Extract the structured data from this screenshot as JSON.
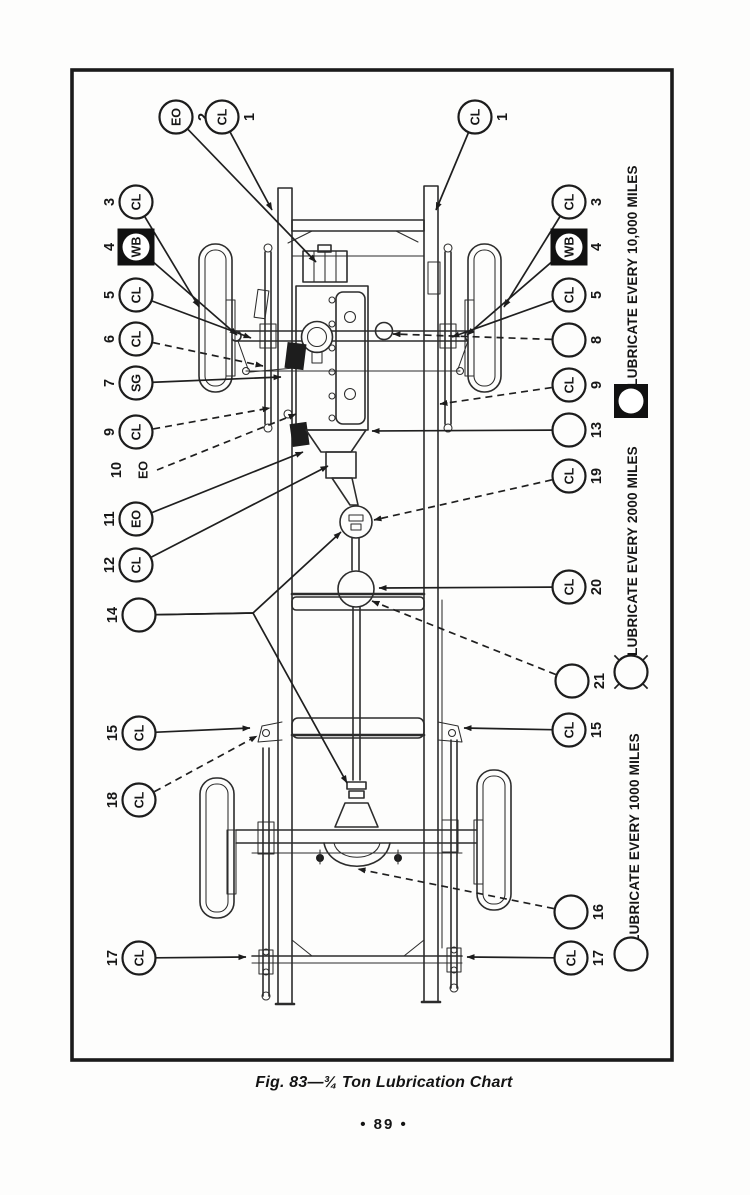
{
  "page": {
    "caption": "Fig. 83—¾ Ton Lubrication Chart",
    "page_number": "• 89 •",
    "ink_color": "#1c1c1c",
    "paper_color": "#fdfdfc"
  },
  "legend": {
    "items": [
      {
        "label": "LUBRICATE EVERY 10,000 MILES",
        "symbol": "black-square-white-circle"
      },
      {
        "label": "LUBRICATE EVERY 2000 MILES",
        "symbol": "circle-with-ticks"
      },
      {
        "label": "LUBRICATE EVERY 1000 MILES",
        "symbol": "plain-circle"
      }
    ]
  },
  "callouts": {
    "items": [
      {
        "number": "2",
        "code": "EO",
        "shape": "circle",
        "x": 176,
        "y": 117,
        "num_side": "right",
        "leaders": [
          {
            "pts": [
              [
                316,
                262
              ]
            ],
            "dashed": false
          }
        ]
      },
      {
        "number": "1",
        "code": "CL",
        "shape": "circle",
        "x": 222,
        "y": 117,
        "num_side": "right",
        "leaders": [
          {
            "pts": [
              [
                272,
                210
              ]
            ],
            "dashed": false
          }
        ]
      },
      {
        "number": "1",
        "code": "CL",
        "shape": "circle",
        "x": 475,
        "y": 117,
        "num_side": "right",
        "leaders": [
          {
            "pts": [
              [
                436,
                210
              ]
            ],
            "dashed": false
          }
        ]
      },
      {
        "number": "3",
        "code": "CL",
        "shape": "circle",
        "x": 136,
        "y": 202,
        "num_side": "left",
        "leaders": [
          {
            "pts": [
              [
                199,
                307
              ]
            ],
            "dashed": false
          }
        ]
      },
      {
        "number": "4",
        "code": "WB",
        "shape": "square",
        "x": 136,
        "y": 247,
        "num_side": "left",
        "leaders": [
          {
            "pts": [
              [
                237,
                335
              ]
            ],
            "dashed": false
          }
        ]
      },
      {
        "number": "5",
        "code": "CL",
        "shape": "circle",
        "x": 136,
        "y": 295,
        "num_side": "left",
        "leaders": [
          {
            "pts": [
              [
                251,
                338
              ]
            ],
            "dashed": false
          }
        ]
      },
      {
        "number": "6",
        "code": "CL",
        "shape": "circle",
        "x": 136,
        "y": 339,
        "num_side": "left",
        "leaders": [
          {
            "pts": [
              [
                263,
                366
              ]
            ],
            "dashed": true
          }
        ]
      },
      {
        "number": "7",
        "code": "SG",
        "shape": "circle",
        "x": 136,
        "y": 383,
        "num_side": "left",
        "leaders": [
          {
            "pts": [
              [
                281,
                377
              ]
            ],
            "dashed": false
          }
        ]
      },
      {
        "number": "9",
        "code": "CL",
        "shape": "circle",
        "x": 136,
        "y": 432,
        "num_side": "left",
        "leaders": [
          {
            "pts": [
              [
                270,
                408
              ]
            ],
            "dashed": true
          }
        ]
      },
      {
        "number": "10",
        "code": "EO",
        "shape": "label",
        "x": 143,
        "y": 470,
        "num_side": "left",
        "leaders": [
          {
            "pts": [
              [
                296,
                414
              ]
            ],
            "dashed": true
          }
        ]
      },
      {
        "number": "11",
        "code": "EO",
        "shape": "circle",
        "x": 136,
        "y": 519,
        "num_side": "left",
        "leaders": [
          {
            "pts": [
              [
                303,
                452
              ]
            ],
            "dashed": false
          }
        ]
      },
      {
        "number": "12",
        "code": "CL",
        "shape": "circle",
        "x": 136,
        "y": 565,
        "num_side": "left",
        "leaders": [
          {
            "pts": [
              [
                328,
                466
              ]
            ],
            "dashed": false
          }
        ]
      },
      {
        "number": "14",
        "code": "",
        "shape": "circle",
        "x": 139,
        "y": 615,
        "num_side": "left",
        "leaders": [
          {
            "pts": [
              [
                253,
                613
              ],
              [
                341,
                532
              ]
            ],
            "dashed": false
          },
          {
            "pts": [
              [
                253,
                613
              ],
              [
                347,
                783
              ]
            ],
            "dashed": false
          }
        ]
      },
      {
        "number": "15",
        "code": "CL",
        "shape": "circle",
        "x": 139,
        "y": 733,
        "num_side": "left",
        "leaders": [
          {
            "pts": [
              [
                250,
                728
              ]
            ],
            "dashed": false
          }
        ]
      },
      {
        "number": "18",
        "code": "CL",
        "shape": "circle",
        "x": 139,
        "y": 800,
        "num_side": "left",
        "leaders": [
          {
            "pts": [
              [
                257,
                736
              ]
            ],
            "dashed": true
          }
        ]
      },
      {
        "number": "17",
        "code": "CL",
        "shape": "circle",
        "x": 139,
        "y": 958,
        "num_side": "left",
        "leaders": [
          {
            "pts": [
              [
                246,
                957
              ]
            ],
            "dashed": false
          }
        ]
      },
      {
        "number": "3",
        "code": "CL",
        "shape": "circle",
        "x": 569,
        "y": 202,
        "num_side": "right",
        "leaders": [
          {
            "pts": [
              [
                504,
                307
              ]
            ],
            "dashed": false
          }
        ]
      },
      {
        "number": "4",
        "code": "WB",
        "shape": "square",
        "x": 569,
        "y": 247,
        "num_side": "right",
        "leaders": [
          {
            "pts": [
              [
                467,
                335
              ]
            ],
            "dashed": false
          }
        ]
      },
      {
        "number": "5",
        "code": "CL",
        "shape": "circle",
        "x": 569,
        "y": 295,
        "num_side": "right",
        "leaders": [
          {
            "pts": [
              [
                452,
                337
              ]
            ],
            "dashed": false
          }
        ]
      },
      {
        "number": "8",
        "code": "",
        "shape": "circle",
        "x": 569,
        "y": 340,
        "num_side": "right",
        "leaders": [
          {
            "pts": [
              [
                393,
                334
              ]
            ],
            "dashed": true
          }
        ]
      },
      {
        "number": "9",
        "code": "CL",
        "shape": "circle",
        "x": 569,
        "y": 385,
        "num_side": "right",
        "leaders": [
          {
            "pts": [
              [
                440,
                404
              ]
            ],
            "dashed": true
          }
        ]
      },
      {
        "number": "13",
        "code": "",
        "shape": "circle",
        "x": 569,
        "y": 430,
        "num_side": "right",
        "leaders": [
          {
            "pts": [
              [
                372,
                431
              ]
            ],
            "dashed": false
          }
        ]
      },
      {
        "number": "19",
        "code": "CL",
        "shape": "circle",
        "x": 569,
        "y": 476,
        "num_side": "right",
        "leaders": [
          {
            "pts": [
              [
                374,
                520
              ]
            ],
            "dashed": true
          }
        ]
      },
      {
        "number": "20",
        "code": "CL",
        "shape": "circle",
        "x": 569,
        "y": 587,
        "num_side": "right",
        "leaders": [
          {
            "pts": [
              [
                379,
                588
              ]
            ],
            "dashed": false
          }
        ]
      },
      {
        "number": "21",
        "code": "",
        "shape": "circle",
        "x": 572,
        "y": 681,
        "num_side": "right",
        "leaders": [
          {
            "pts": [
              [
                372,
                601
              ]
            ],
            "dashed": true
          }
        ]
      },
      {
        "number": "15",
        "code": "CL",
        "shape": "circle",
        "x": 569,
        "y": 730,
        "num_side": "right",
        "leaders": [
          {
            "pts": [
              [
                464,
                728
              ]
            ],
            "dashed": false
          }
        ]
      },
      {
        "number": "16",
        "code": "",
        "shape": "circle",
        "x": 571,
        "y": 912,
        "num_side": "right",
        "leaders": [
          {
            "pts": [
              [
                358,
                869
              ]
            ],
            "dashed": true
          }
        ]
      },
      {
        "number": "17",
        "code": "CL",
        "shape": "circle",
        "x": 571,
        "y": 958,
        "num_side": "right",
        "leaders": [
          {
            "pts": [
              [
                467,
                957
              ]
            ],
            "dashed": false
          }
        ]
      }
    ]
  }
}
